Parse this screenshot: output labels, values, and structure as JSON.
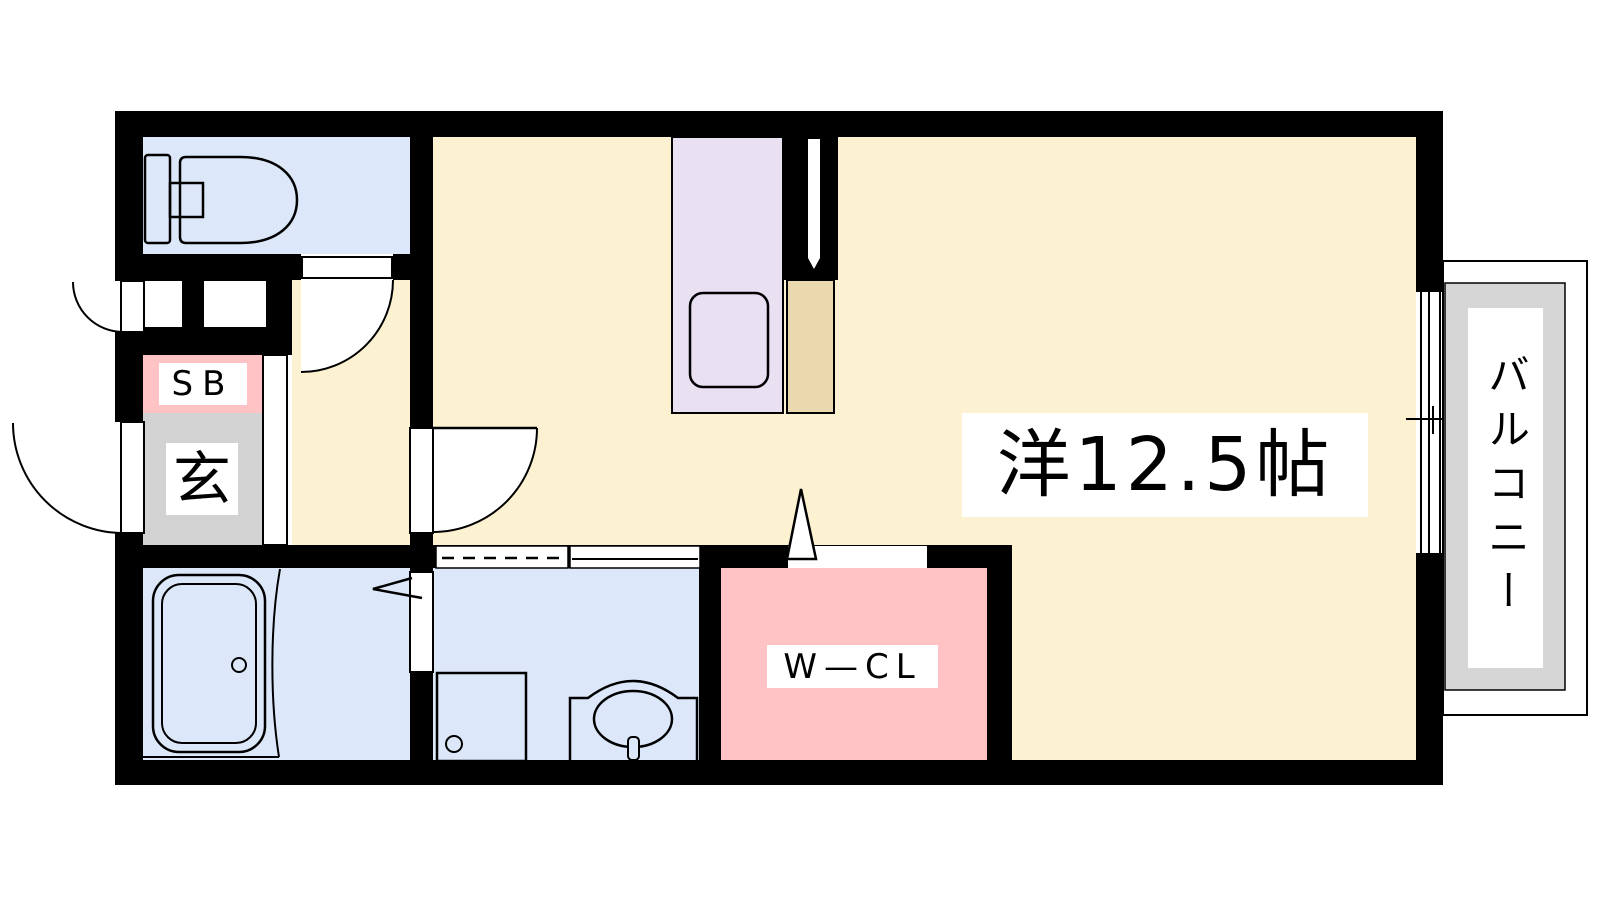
{
  "document": {
    "type": "apartment-floor-plan",
    "description": "Japanese 1R/1K apartment floor plan drawing"
  },
  "rooms": {
    "main": {
      "label": "洋12.5帖"
    },
    "walk_in_closet": {
      "label": "W—CL"
    },
    "shoe_box": {
      "label": "SB"
    },
    "genkan": {
      "label": "玄"
    },
    "balcony": {
      "label": "バルコニー"
    }
  },
  "fixtures": [
    "toilet-icon",
    "bathtub-icon",
    "washing-machine-icon",
    "washbasin-icon",
    "kitchen-sink-icon",
    "refrigerator-space",
    "duct-slit",
    "sliding-window",
    "entrance-door",
    "service-door",
    "toilet-door",
    "living-door",
    "bathroom-folding-door",
    "washroom-sliding-door",
    "closet-opening"
  ],
  "colors": {
    "wall": "#000000",
    "main_room_floor": "#FCF1D0",
    "wet_area_floor": "#DCE8F9",
    "kitchen_counter": "#E9E0F2",
    "closet_pink": "#FFC3C6",
    "genkan_gray": "#D2D2D2",
    "balcony_gray": "#D6D6D6",
    "refrigerator_tan": "#EAD8AE"
  }
}
